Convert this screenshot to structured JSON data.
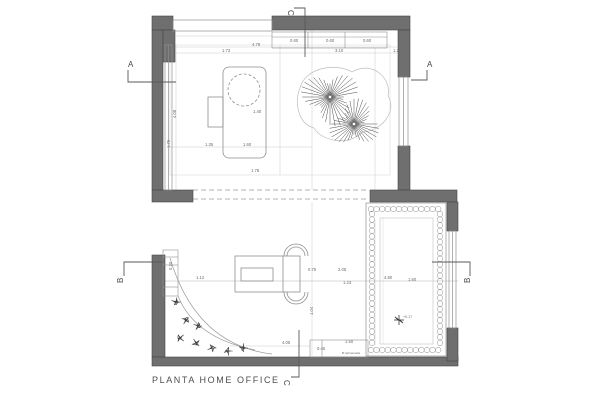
{
  "title": "PLANTA HOME OFFICE",
  "colors": {
    "background": "#ffffff",
    "wall_fill": "#6f6f6f",
    "wall_stroke": "#464646",
    "furniture_line": "#8f8f8f",
    "light_line": "#c9c9c9",
    "dim_line": "#b5b5b5",
    "plant_line": "#4a4a4a",
    "text": "#6b6b6b"
  },
  "annotations": {
    "section_markers": [
      {
        "label": "A",
        "x": 128,
        "y": 67,
        "r": 0
      },
      {
        "label": "A",
        "x": 427,
        "y": 67,
        "r": 0
      },
      {
        "label": "B",
        "x": 123,
        "y": 283,
        "r": -90
      },
      {
        "label": "B",
        "x": 470,
        "y": 283,
        "r": -90
      },
      {
        "label": "C",
        "x": 288,
        "y": 10,
        "r": 90
      },
      {
        "label": "C",
        "x": 284,
        "y": 380,
        "r": 90
      }
    ],
    "dimension_labels": [
      {
        "t": "0.60",
        "x": 290,
        "y": 42
      },
      {
        "t": "0.60",
        "x": 326,
        "y": 42
      },
      {
        "t": "0.60",
        "x": 363,
        "y": 42
      },
      {
        "t": "4.78",
        "x": 252,
        "y": 46
      },
      {
        "t": "1.73",
        "x": 222,
        "y": 52
      },
      {
        "t": "3.10",
        "x": 335,
        "y": 52
      },
      {
        "t": "1.20",
        "x": 393,
        "y": 52
      },
      {
        "t": "1.40",
        "x": 253,
        "y": 113
      },
      {
        "t": "1.35",
        "x": 205,
        "y": 146
      },
      {
        "t": "1.60",
        "x": 243,
        "y": 146
      },
      {
        "t": "1.78",
        "x": 251,
        "y": 172
      },
      {
        "t": "4.08",
        "x": 176,
        "y": 118,
        "r": -90
      },
      {
        "t": "1.75",
        "x": 170,
        "y": 148,
        "r": -90
      },
      {
        "t": "1.12",
        "x": 196,
        "y": 279
      },
      {
        "t": "0.75",
        "x": 308,
        "y": 271
      },
      {
        "t": "2.05",
        "x": 338,
        "y": 271
      },
      {
        "t": "1.23",
        "x": 343,
        "y": 284
      },
      {
        "t": "4.80",
        "x": 384,
        "y": 279
      },
      {
        "t": "1.60",
        "x": 408,
        "y": 281
      },
      {
        "t": "1.04",
        "x": 313,
        "y": 315,
        "r": -90
      },
      {
        "t": "4.05",
        "x": 282,
        "y": 344
      },
      {
        "t": "1.50",
        "x": 345,
        "y": 343
      },
      {
        "t": "0.45",
        "x": 317,
        "y": 350
      },
      {
        "t": "0.30",
        "x": 172,
        "y": 270,
        "r": -90
      }
    ],
    "level_marker": {
      "t": "+0.17",
      "x": 403,
      "y": 318
    },
    "notes": [
      {
        "t": "B.Aj/cascada",
        "x": 342,
        "y": 354,
        "size": 3.1
      }
    ]
  },
  "plants": {
    "tree_clusters": [
      {
        "x": 330,
        "y": 97,
        "r": 30
      },
      {
        "x": 354,
        "y": 124,
        "r": 26
      }
    ],
    "shrub_patches": [
      {
        "x": 176,
        "y": 302
      },
      {
        "x": 186,
        "y": 320
      },
      {
        "x": 180,
        "y": 338
      },
      {
        "x": 196,
        "y": 343
      },
      {
        "x": 212,
        "y": 348
      },
      {
        "x": 228,
        "y": 351
      },
      {
        "x": 243,
        "y": 348
      },
      {
        "x": 198,
        "y": 326
      }
    ]
  }
}
